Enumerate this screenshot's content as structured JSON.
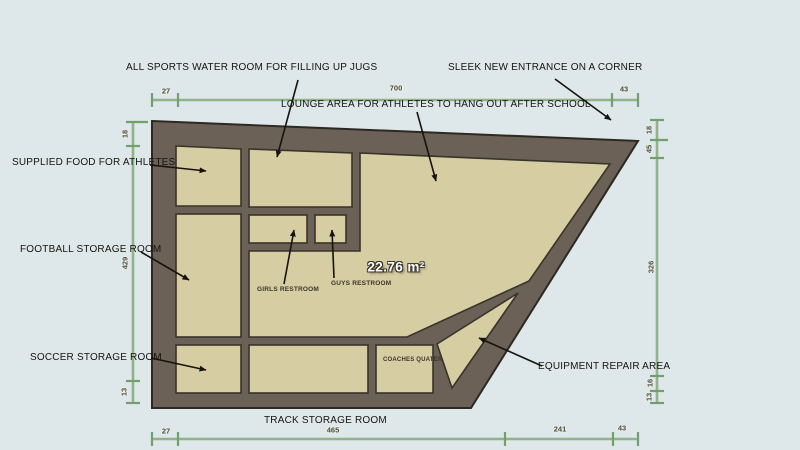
{
  "plan": {
    "background": "#dee7ea",
    "wall_color": "#6b6156",
    "wall_outline": "#2c2822",
    "floor_color": "#d7cda2",
    "dim_color": "#8fb489",
    "dim_tick_color": "#72a06d",
    "area_label": "22.76 m²"
  },
  "callouts": {
    "water": "ALL SPORTS WATER ROOM FOR FILLING UP JUGS",
    "entrance": "SLEEK NEW ENTRANCE ON A CORNER",
    "lounge": "LOUNGE AREA FOR ATHLETES TO HANG OUT AFTER SCHOOL",
    "supplied_food": "SUPPLIED FOOD FOR ATHLETES",
    "football": "FOOTBALL STORAGE ROOM",
    "soccer": "SOCCER STORAGE ROOM",
    "track": "TRACK STORAGE ROOM",
    "equipment": "EQUIPMENT REPAIR AREA"
  },
  "room_labels": {
    "girls": "GIRLS RESTROOM",
    "guys": "GUYS RESTROOM",
    "coaches": "COACHES QUATER"
  },
  "dims": {
    "top": [
      "27",
      "700",
      "43"
    ],
    "bottom": [
      "27",
      "465",
      "241",
      "43"
    ],
    "left": [
      "18",
      "429",
      "13"
    ],
    "right": [
      "18",
      "45",
      "326",
      "16",
      "13"
    ]
  }
}
